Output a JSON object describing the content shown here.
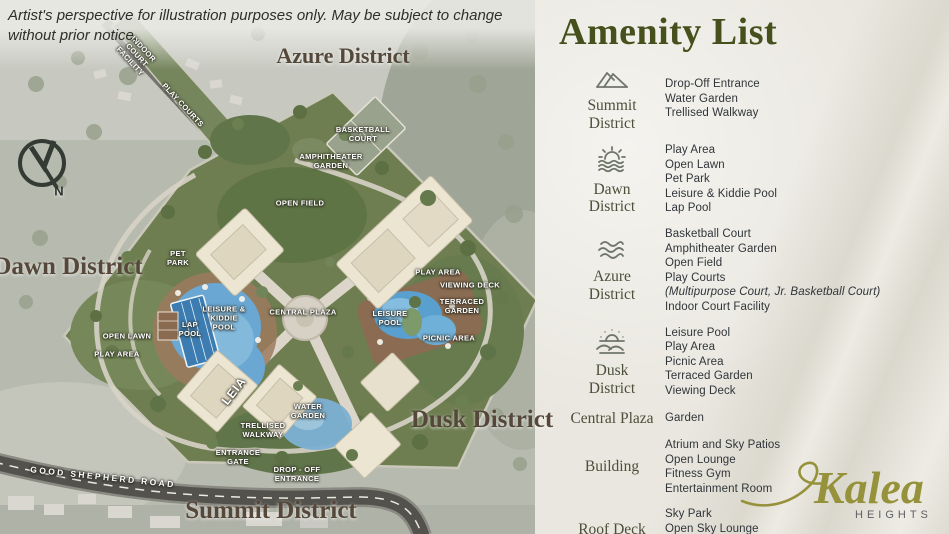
{
  "disclaimer": "Artist's perspective for illustration purposes only. May be subject to change without prior notice.",
  "amenity_list": {
    "title": "Amenity List",
    "rows": [
      {
        "label": "Summit District",
        "icon": "mountains",
        "items": [
          "Drop-Off Entrance",
          "Water Garden",
          "Trellised Walkway"
        ]
      },
      {
        "label": "Dawn District",
        "icon": "sunrise",
        "items": [
          "Play Area",
          "Open Lawn",
          "Pet Park",
          "Leisure & Kiddie Pool",
          "Lap Pool"
        ]
      },
      {
        "label": "Azure District",
        "icon": "waves",
        "items": [
          "Basketball Court",
          "Amphitheater Garden",
          "Open Field",
          "Play Courts",
          "(Multipurpose Court, Jr. Basketball Court)",
          "Indoor Court Facility"
        ]
      },
      {
        "label": "Dusk District",
        "icon": "sunset",
        "items": [
          "Leisure Pool",
          "Play Area",
          "Picnic Area",
          "Terraced Garden",
          "Viewing Deck"
        ]
      },
      {
        "label": "Central Plaza",
        "icon": null,
        "items": [
          "Garden"
        ]
      },
      {
        "label": "Building",
        "icon": null,
        "items": [
          "Atrium and Sky Patios",
          "Open Lounge",
          "Fitness Gym",
          "Entertainment Room"
        ]
      },
      {
        "label": "Roof Deck",
        "icon": null,
        "items": [
          "Sky Park",
          "Open Sky Lounge",
          "Sky Bridge"
        ]
      }
    ]
  },
  "map": {
    "district_labels": {
      "azure": "Azure District",
      "dawn": "Dawn District",
      "dusk": "Dusk District",
      "summit": "Summit District"
    },
    "labels": {
      "basketball_court": "BASKETBALL COURT",
      "amphitheater_garden": "AMPHITHEATER GARDEN",
      "open_field": "OPEN FIELD",
      "pet_park": "PET PARK",
      "open_lawn": "OPEN LAWN",
      "play_area_west": "PLAY AREA",
      "lap_pool": "LAP POOL",
      "leisure_kiddie_pool": "LEISURE & KIDDIE POOL",
      "central_plaza": "CENTRAL PLAZA",
      "leisure_pool": "LEISURE POOL",
      "play_area_east": "PLAY AREA",
      "viewing_deck": "VIEWING DECK",
      "terraced_garden": "TERRACED GARDEN",
      "picnic_area": "PICNIC AREA",
      "water_garden": "WATER GARDEN",
      "trellised_walkway": "TRELLISED WALKWAY",
      "entrance_gate": "ENTRANCE GATE",
      "drop_off_entrance": "DROP - OFF ENTRANCE",
      "play_courts": "PLAY COURTS",
      "indoor_court_facility": "INDOOR COURT FACILITY",
      "building_tower": "LEIA",
      "road": "GOOD SHEPHERD ROAD",
      "compass_n": "N"
    }
  },
  "logo": {
    "name": "Kalea",
    "sub": "HEIGHTS"
  },
  "colors": {
    "accent_olive": "#46501d",
    "logo_gold": "#96923c",
    "panel_bg": "#e9e7df",
    "site_green": "#6e7e51",
    "pool_blue": "#5aa0cf",
    "text_dark": "#30353a"
  }
}
